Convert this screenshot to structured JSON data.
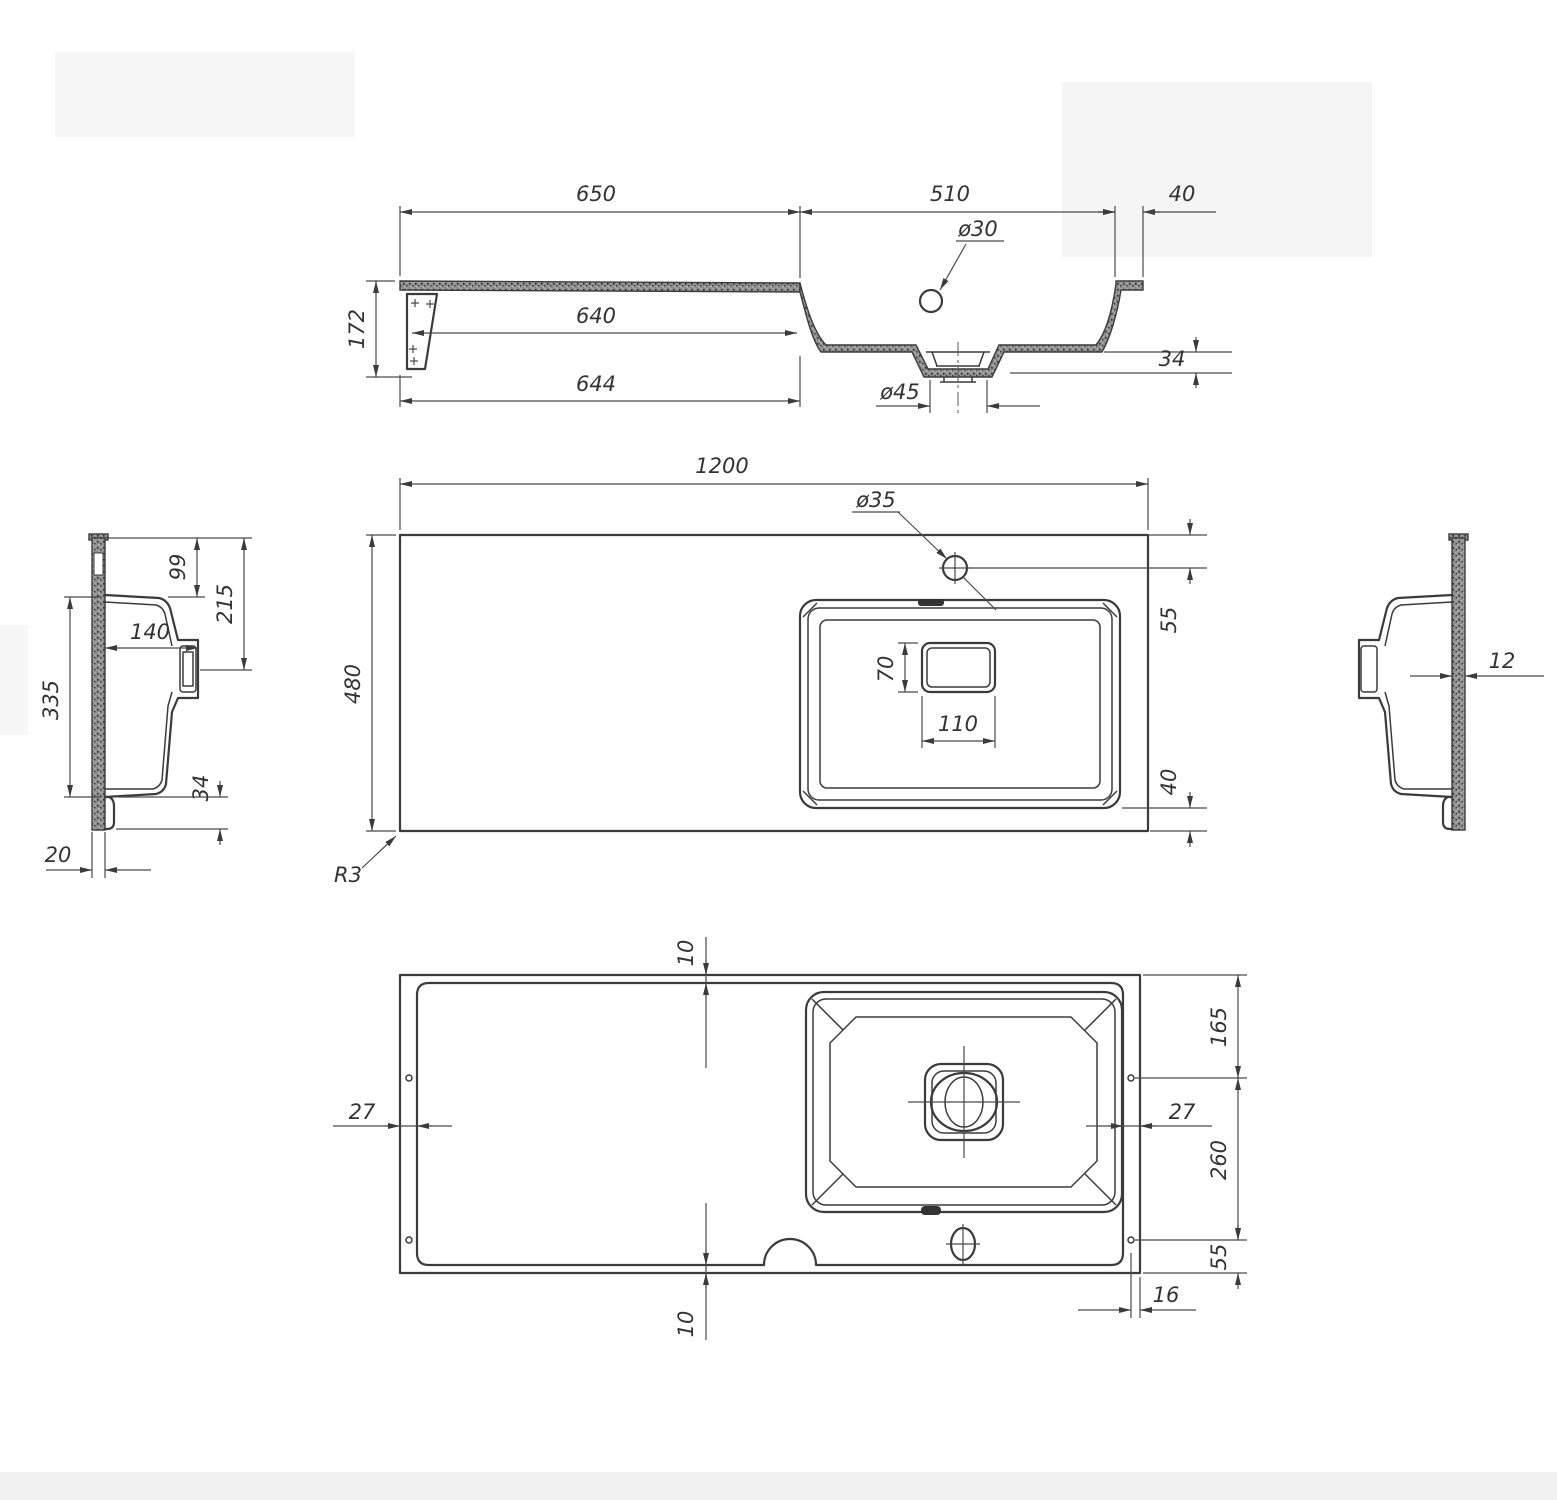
{
  "drawing_title": "sink-technical-drawing",
  "colors": {
    "background": "#ffffff",
    "line": "#3b3b3b",
    "dimension": "#4a4a4a",
    "text": "#333333"
  },
  "views": {
    "side_section": {
      "d650": "650",
      "d510": "510",
      "d40": "40",
      "d30": "ø30",
      "d640": "640",
      "d172": "172",
      "d644": "644",
      "d45": "ø45",
      "d34": "34"
    },
    "plan": {
      "d1200": "1200",
      "d35": "ø35",
      "d480": "480",
      "d55": "55",
      "d70": "70",
      "d110": "110",
      "d40": "40",
      "r3": "R3"
    },
    "left_profile": {
      "d99": "99",
      "d215": "215",
      "d140": "140",
      "d335": "335",
      "d34": "34",
      "d20": "20"
    },
    "right_profile": {
      "d12": "12"
    },
    "bottom": {
      "d10_top": "10",
      "d165": "165",
      "d27_left": "27",
      "d27_right": "27",
      "d260": "260",
      "d55": "55",
      "d10_bottom": "10",
      "d16": "16"
    }
  }
}
